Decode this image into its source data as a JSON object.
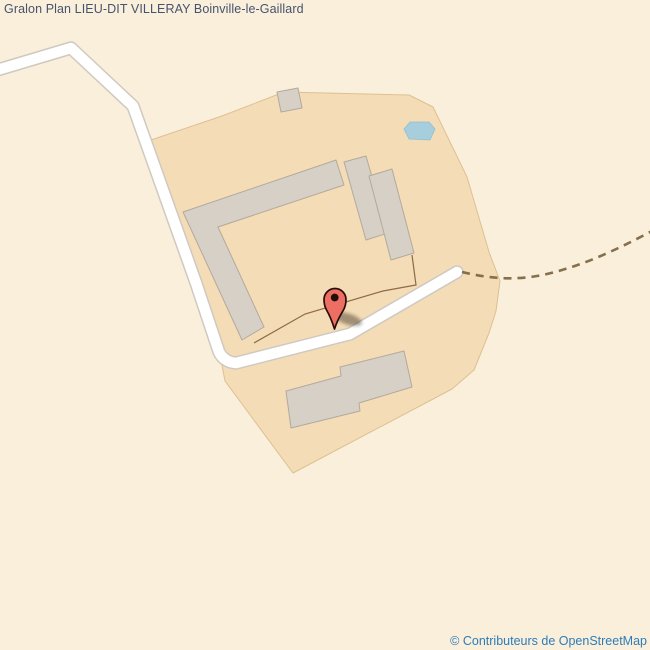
{
  "header": {
    "title": "Gralon Plan LIEU-DIT VILLERAY Boinville-le-Gaillard"
  },
  "map": {
    "attribution_text": "© Contributeurs de OpenStreetMap",
    "marker": {
      "name": "location-marker",
      "shape": "red-pin"
    }
  },
  "colors": {
    "background": "#f9efdb",
    "farmyard": "#f4dcb6",
    "farmyard_border": "#ddc092",
    "building": "#d6d0c7",
    "building_border": "#b3a99c",
    "road": "#ffffff",
    "road_casing": "#cfc9c0",
    "track_dashed": "#84704c",
    "fence": "#8d6b46",
    "water": "#a6cedd",
    "water_border": "#93bfcf",
    "marker_fill": "#ed6e63",
    "marker_outline": "#2b0d08",
    "marker_dot": "#20100a",
    "title_text": "#46536e",
    "attribution_link": "#2e7cb8"
  }
}
